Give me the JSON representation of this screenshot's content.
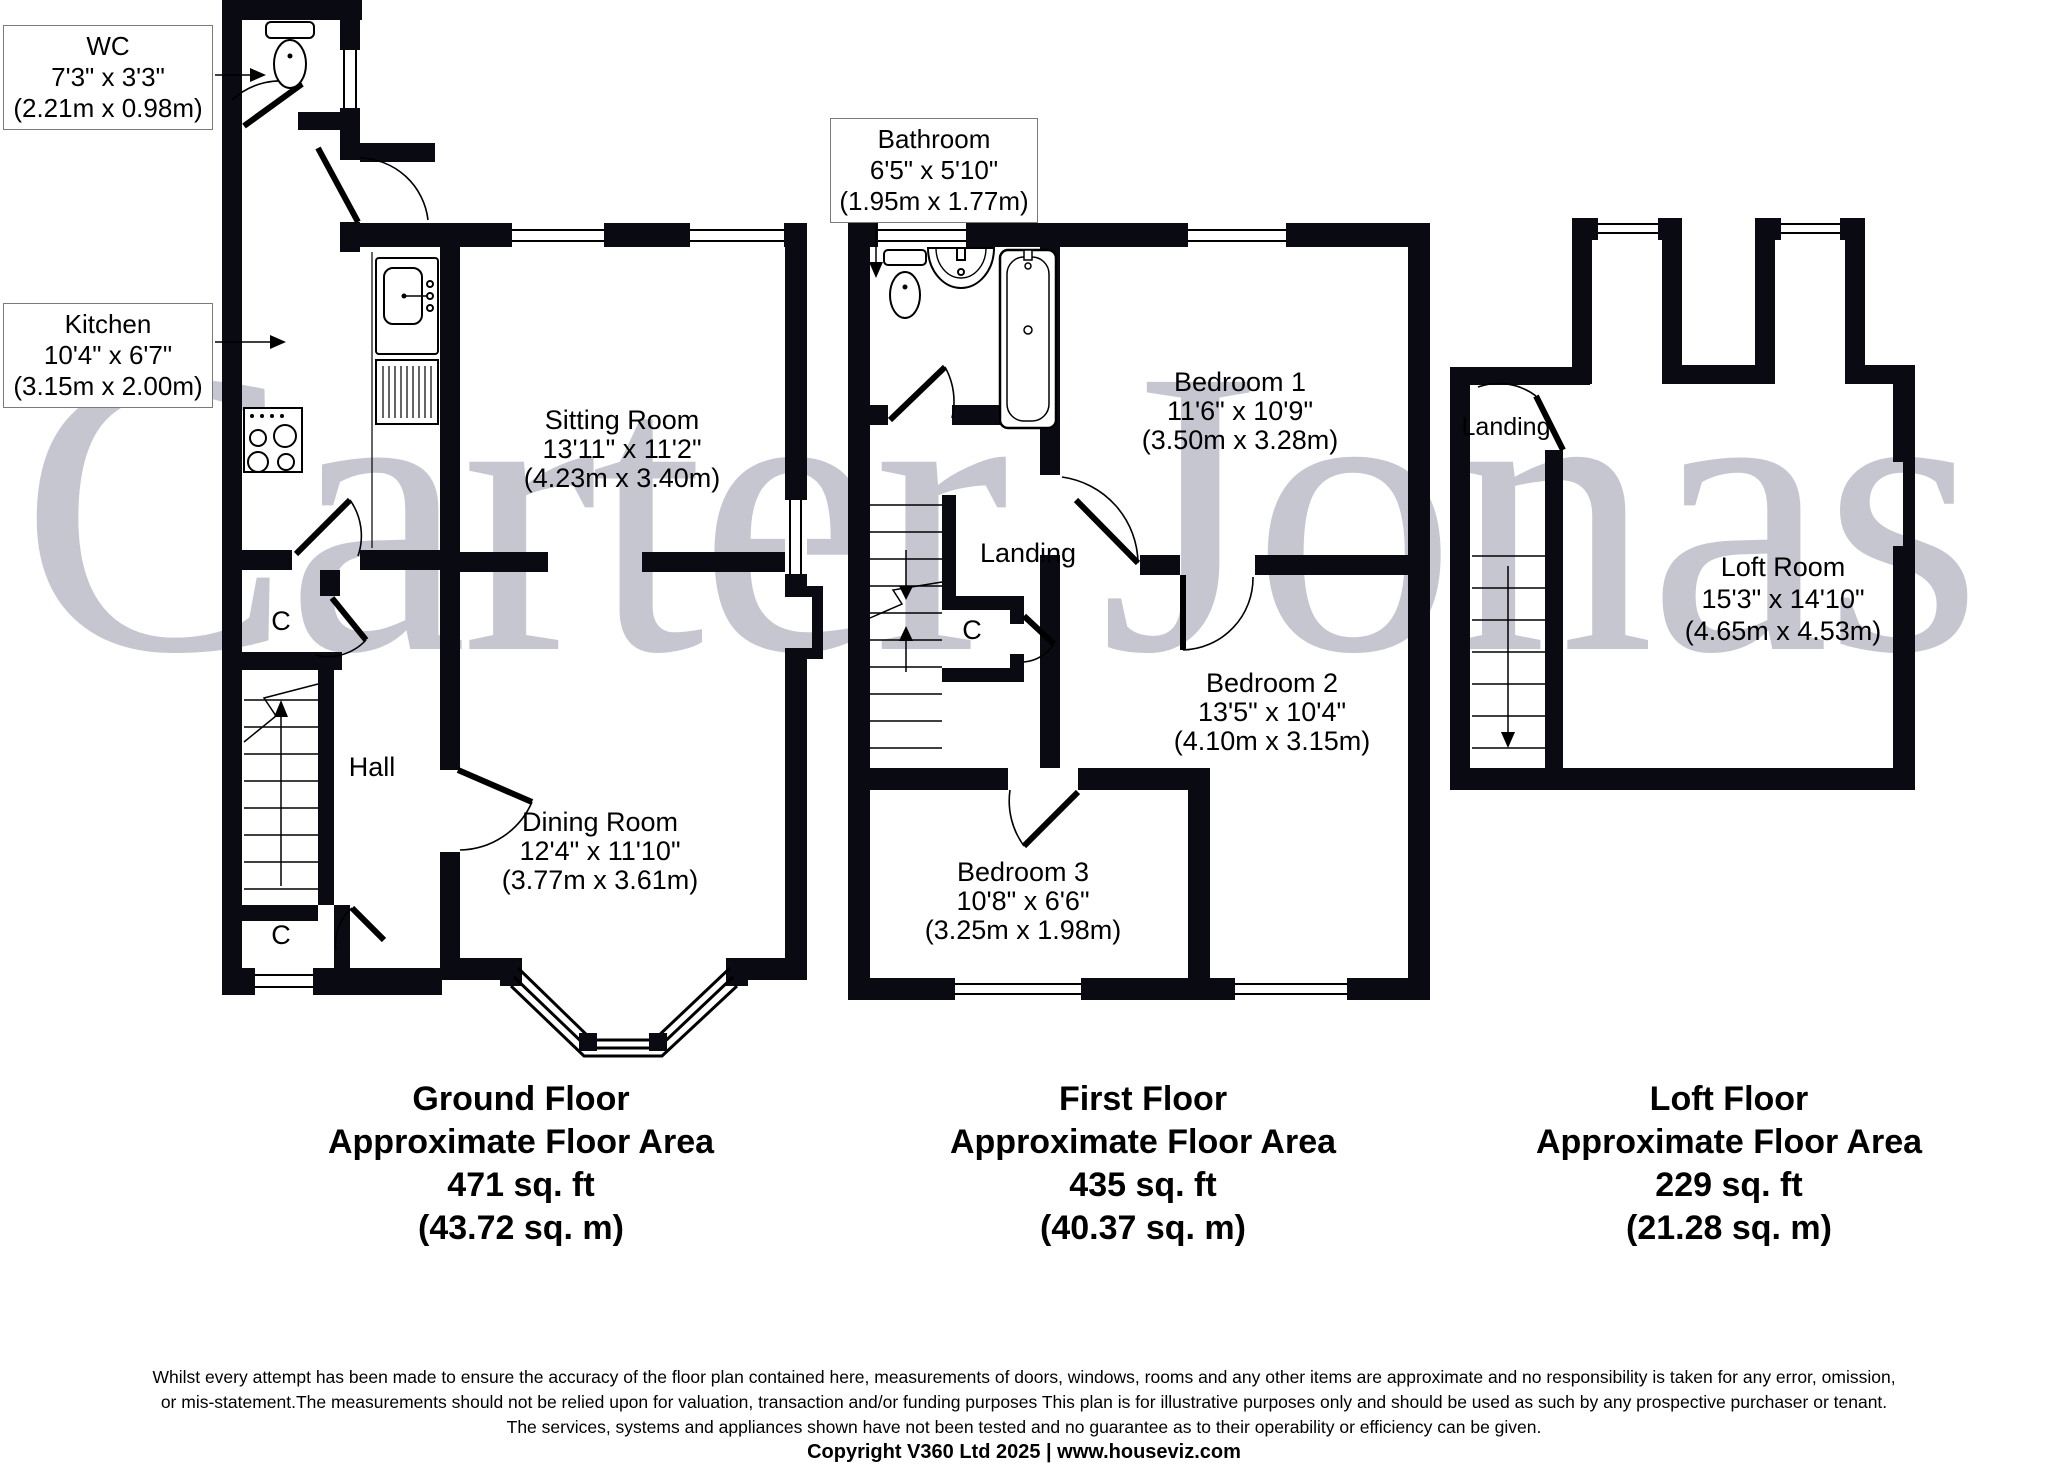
{
  "watermark": {
    "text": "Carter Jonas"
  },
  "callouts": {
    "wc": {
      "name": "WC",
      "imperial": "7'3\" x 3'3\"",
      "metric": "(2.21m x 0.98m)"
    },
    "kitchen": {
      "name": "Kitchen",
      "imperial": "10'4\" x 6'7\"",
      "metric": "(3.15m x 2.00m)"
    },
    "bathroom": {
      "name": "Bathroom",
      "imperial": "6'5\" x 5'10\"",
      "metric": "(1.95m x 1.77m)"
    }
  },
  "ground_floor": {
    "rooms": {
      "sitting_room": {
        "name": "Sitting Room",
        "imperial": "13'11\" x 11'2\"",
        "metric": "(4.23m x 3.40m)"
      },
      "dining_room": {
        "name": "Dining Room",
        "imperial": "12'4\" x 11'10\"",
        "metric": "(3.77m x 3.61m)"
      },
      "hall": {
        "name": "Hall"
      },
      "cupboard_upper": {
        "label": "C"
      },
      "cupboard_lower": {
        "label": "C"
      }
    },
    "title": {
      "floor": "Ground Floor",
      "area_label": "Approximate Floor Area",
      "area_imperial": "471 sq. ft",
      "area_metric": "(43.72 sq. m)"
    }
  },
  "first_floor": {
    "rooms": {
      "bedroom1": {
        "name": "Bedroom 1",
        "imperial": "11'6\" x 10'9\"",
        "metric": "(3.50m x 3.28m)"
      },
      "bedroom2": {
        "name": "Bedroom 2",
        "imperial": "13'5\" x 10'4\"",
        "metric": "(4.10m x 3.15m)"
      },
      "bedroom3": {
        "name": "Bedroom 3",
        "imperial": "10'8\" x 6'6\"",
        "metric": "(3.25m x 1.98m)"
      },
      "landing": {
        "name": "Landing"
      },
      "cupboard": {
        "label": "C"
      }
    },
    "title": {
      "floor": "First Floor",
      "area_label": "Approximate Floor Area",
      "area_imperial": "435 sq. ft",
      "area_metric": "(40.37 sq. m)"
    }
  },
  "loft_floor": {
    "rooms": {
      "loft_room": {
        "name": "Loft Room",
        "imperial": "15'3\" x 14'10\"",
        "metric": "(4.65m x 4.53m)"
      },
      "landing": {
        "name": "Landing"
      }
    },
    "title": {
      "floor": "Loft Floor",
      "area_label": "Approximate Floor Area",
      "area_imperial": "229 sq. ft",
      "area_metric": "(21.28 sq. m)"
    }
  },
  "footer": {
    "line1": "Whilst every attempt has been made to ensure the accuracy of the floor plan contained here, measurements of doors, windows, rooms and any other items are approximate and no responsibility is taken for any error, omission,",
    "line2": "or mis-statement.The measurements should not be relied upon for valuation, transaction and/or funding purposes This plan is for illustrative purposes only and should be used as such by any prospective purchaser or tenant.",
    "line3": "The services, systems and appliances shown have not been tested and no guarantee as to their operability or efficiency can be given.",
    "copyright": "Copyright V360 Ltd 2025 | www.houseviz.com"
  }
}
